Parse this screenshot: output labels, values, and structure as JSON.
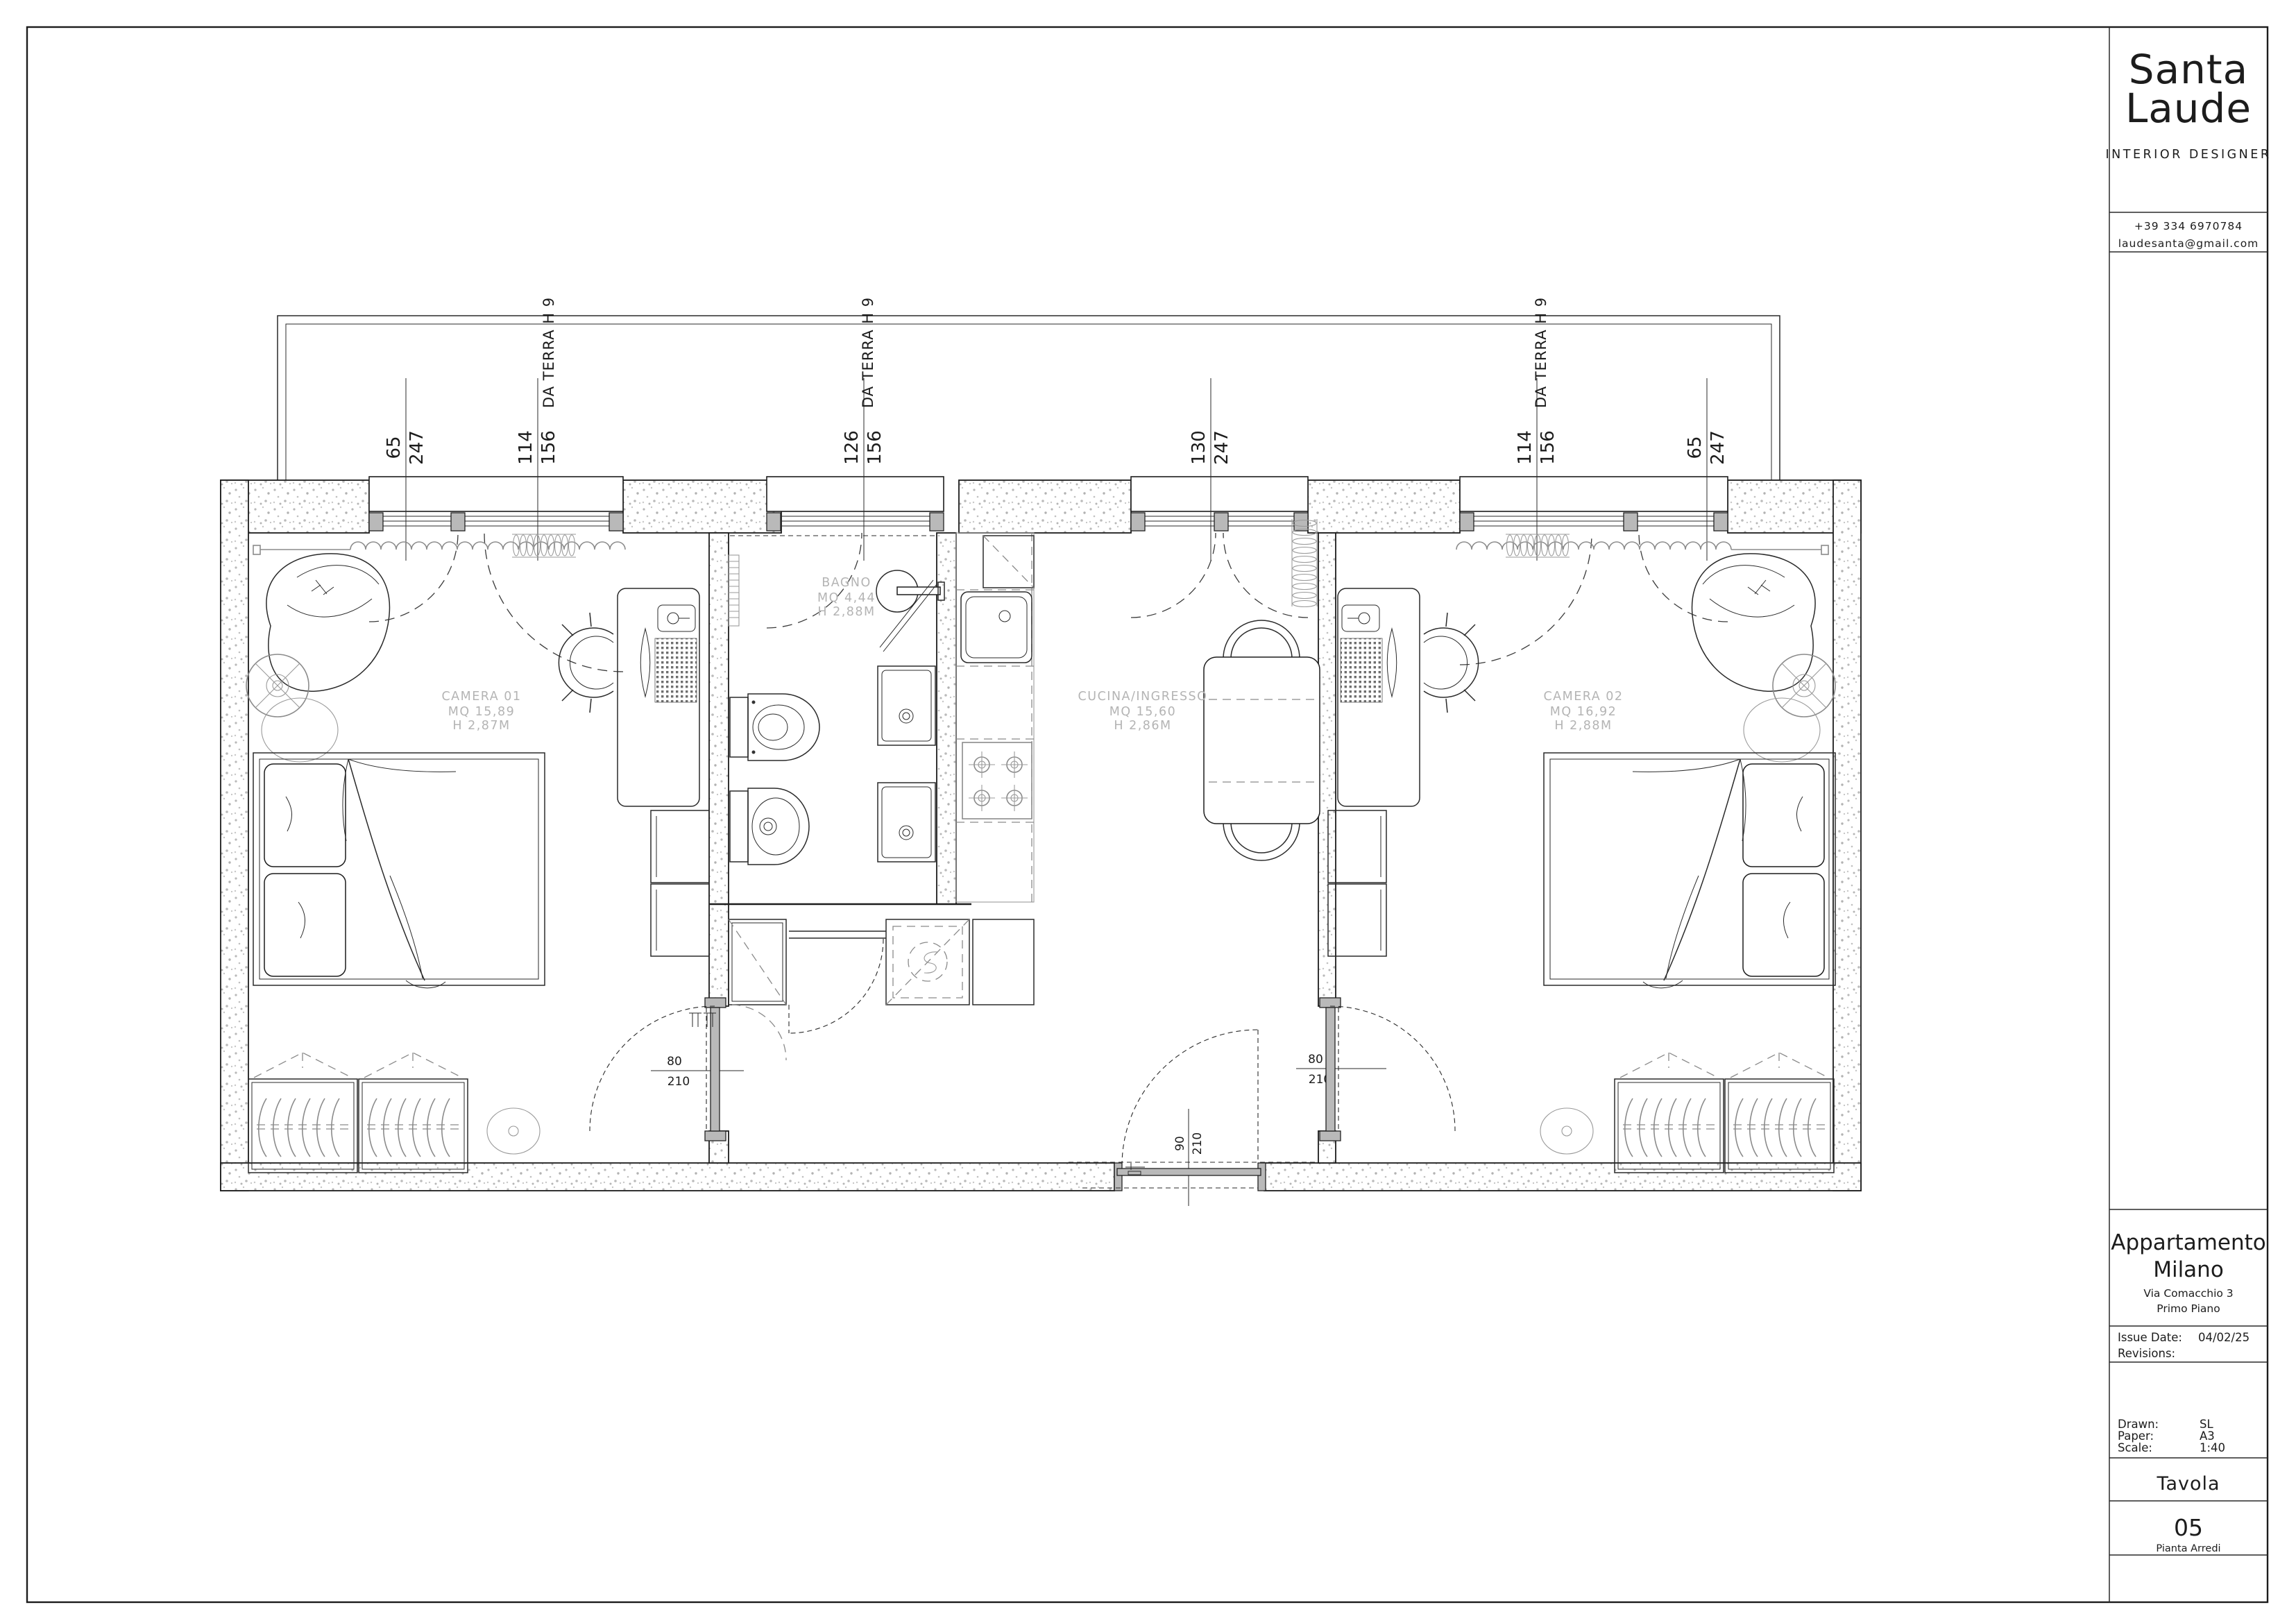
{
  "branding": {
    "name_line1": "Santa",
    "name_line2": "Laude",
    "tagline": "INTERIOR DESIGNER",
    "phone": "+39 334 6970784",
    "email": "laudesanta@gmail.com"
  },
  "title_block": {
    "project_line1": "Appartamento",
    "project_line2": "Milano",
    "address": "Via Comacchio 3",
    "floor": "Primo Piano",
    "issue_date_label": "Issue Date:",
    "issue_date": "04/02/25",
    "revisions_label": "Revisions:",
    "drawn_label": "Drawn:",
    "drawn_value": "SL",
    "paper_label": "Paper:",
    "paper_value": "A3",
    "scale_label": "Scale:",
    "scale_value": "1:40",
    "sheet_label": "Tavola",
    "sheet_number": "05",
    "sheet_name": "Pianta Arredi"
  },
  "rooms": {
    "camera01": {
      "name": "CAMERA 01",
      "area": "MQ 15,89",
      "height": "H 2,87M"
    },
    "bagno": {
      "name": "BAGNO",
      "area": "MQ 4,44",
      "height": "H 2,88M"
    },
    "cucina": {
      "name": "CUCINA/INGRESSO",
      "area": "MQ 15,60",
      "height": "H 2,86M"
    },
    "camera02": {
      "name": "CAMERA 02",
      "area": "MQ 16,92",
      "height": "H 2,88M"
    }
  },
  "window_dims": [
    {
      "width": "65",
      "height": "247"
    },
    {
      "width": "114",
      "height": "156"
    },
    {
      "width": "126",
      "height": "156"
    },
    {
      "width": "130",
      "height": "247"
    },
    {
      "width": "114",
      "height": "156"
    },
    {
      "width": "65",
      "height": "247"
    }
  ],
  "window_note": "DA TERRA H 9",
  "door_dims": [
    {
      "width": "80",
      "height": "210"
    },
    {
      "width": "90",
      "height": "210"
    },
    {
      "width": "80",
      "height": "210"
    }
  ],
  "colors": {
    "line": "#1c1c1c",
    "gray_line": "#8b8b8b",
    "label_gray": "#b4b4b4",
    "door_fill": "#b9b9b9",
    "stipple_dot": "#bcbcbc"
  }
}
